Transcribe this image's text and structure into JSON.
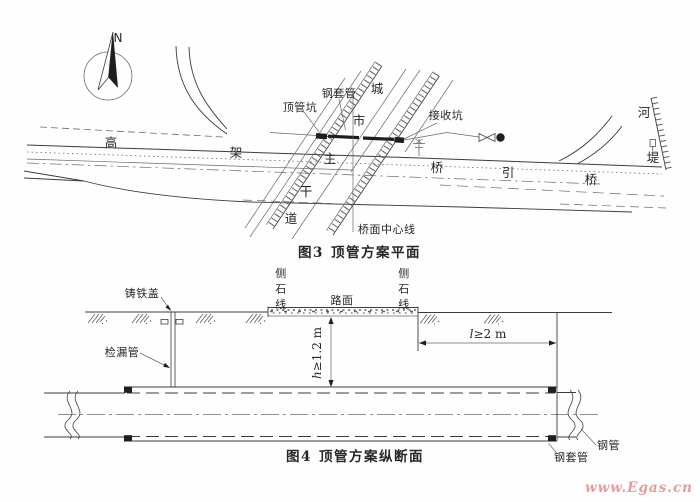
{
  "page": {
    "background": "#fefefe",
    "ink": "#3c3c3c",
    "watermark_color": "#e59c9c"
  },
  "watermark": {
    "text": "www.Egas.cn"
  },
  "figure3": {
    "caption_num": "图3",
    "caption_title": "顶管方案平面",
    "north": "N",
    "labels": {
      "steel_casing": "钢套管",
      "jacking_pit": "顶管坑",
      "receiving_pit": "接收坑",
      "bridge_centerline": "桥面中心线",
      "city_main_road": [
        "城",
        "市",
        "主",
        "干",
        "道"
      ],
      "elevated_bridge": [
        "高",
        "架",
        "桥"
      ],
      "approach_bridge": [
        "引",
        "桥"
      ],
      "river_embankment": [
        "河",
        "堤"
      ]
    }
  },
  "figure4": {
    "caption_num": "图4",
    "caption_title": "顶管方案纵断面",
    "labels": {
      "cast_iron_cover": "铸铁盖",
      "leak_check_pipe": "检漏管",
      "curb_line_left": [
        "侧",
        "石",
        "线"
      ],
      "curb_line_right": [
        "侧",
        "石",
        "线"
      ],
      "road_surface": "路面",
      "steel_pipe": "钢管",
      "steel_casing": "钢套管",
      "dim_depth": {
        "var": "h",
        "rest": "≥1.2 m"
      },
      "dim_length": {
        "var": "l",
        "rest": "≥2 m"
      }
    }
  }
}
